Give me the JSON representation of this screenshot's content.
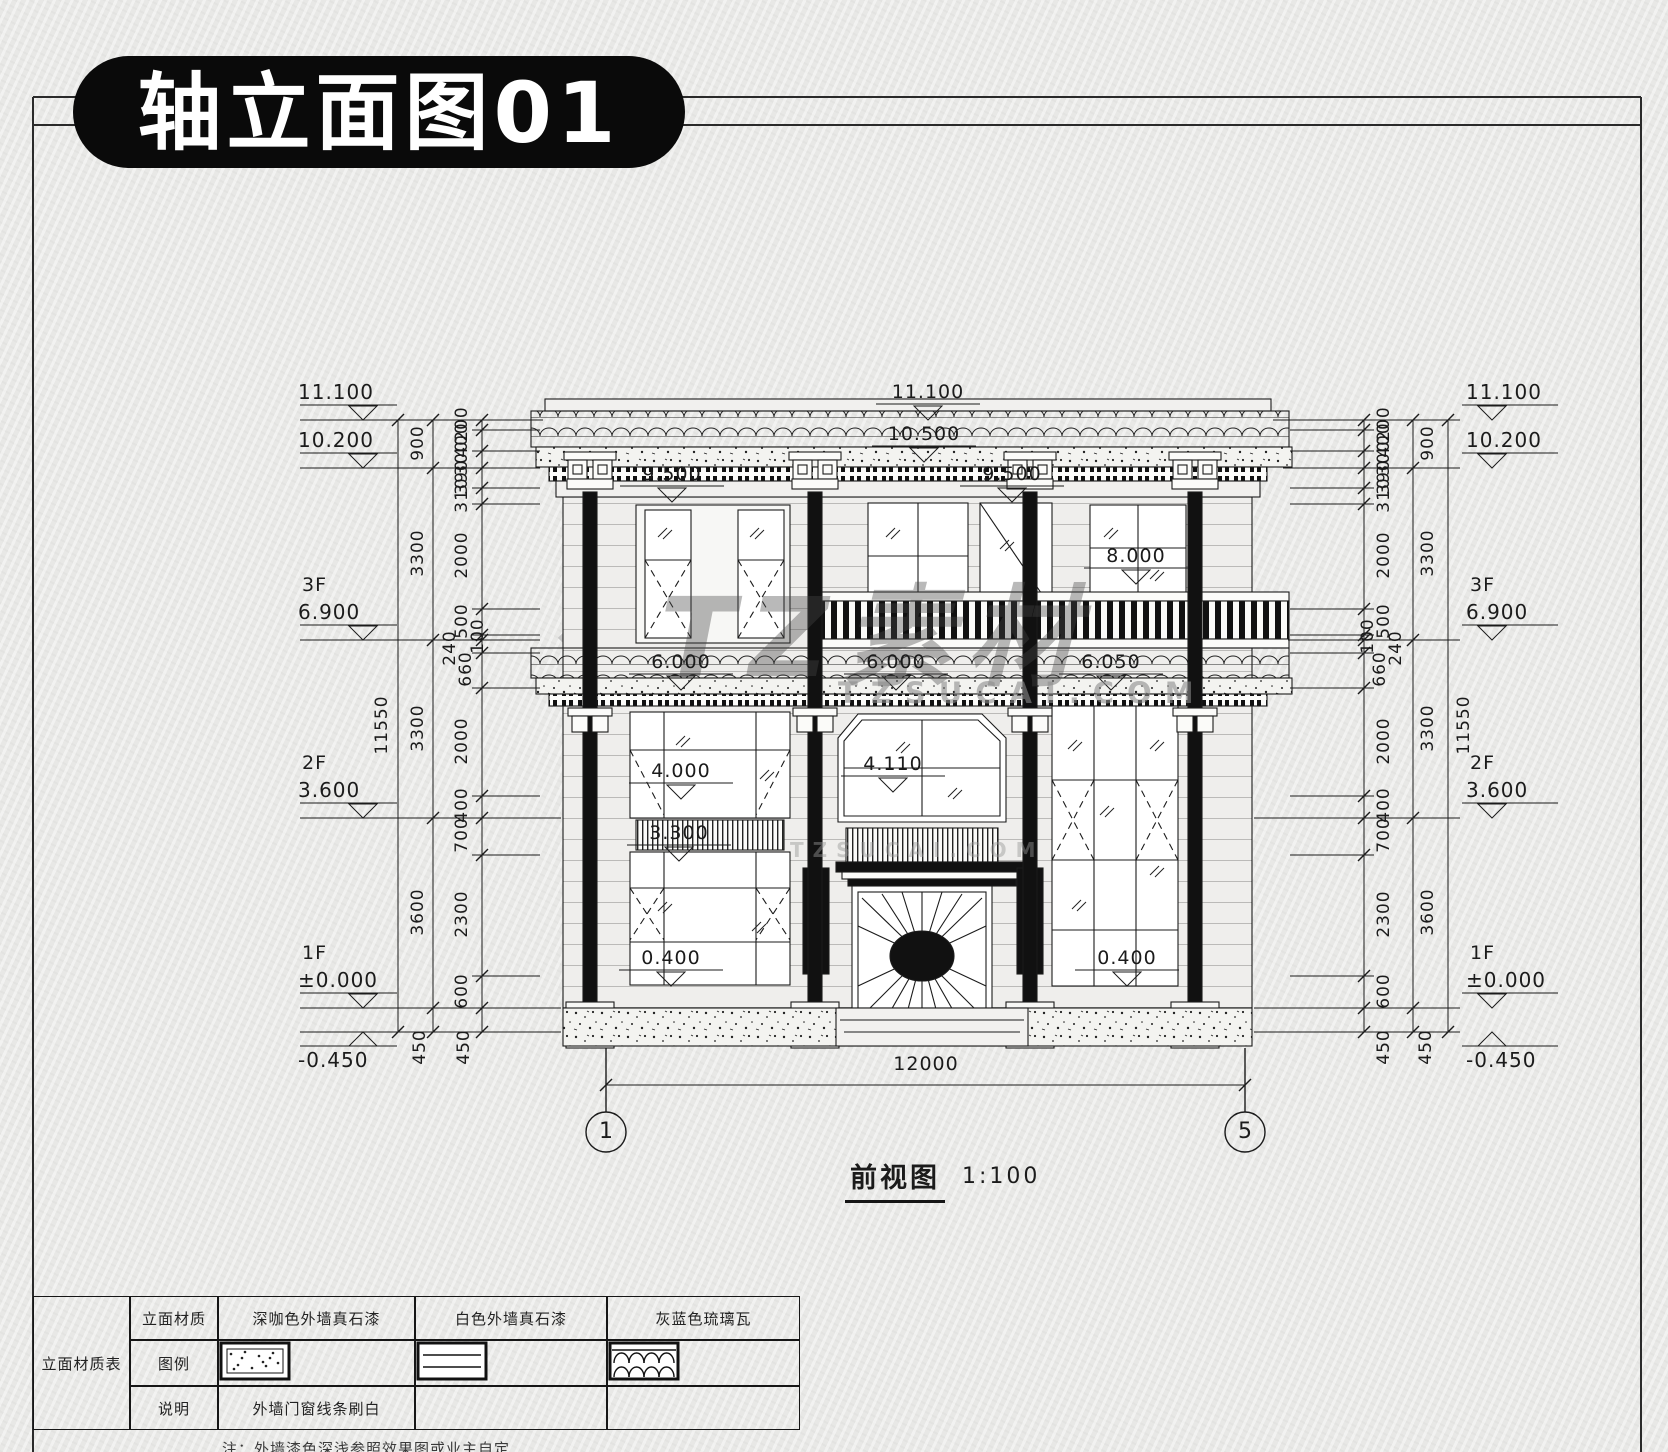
{
  "title": "轴立面图01",
  "caption": {
    "name": "前视图",
    "scale": "1:100"
  },
  "axis": {
    "left": "1",
    "right": "5"
  },
  "watermarks": {
    "big": "TZ素材",
    "site": "TZSUCAI.COM",
    "site_small": "TZSUCAI.COM"
  },
  "note": "注：外墙漆色深浅参照效果图或业主自定",
  "levels_left": [
    {
      "floor": "",
      "value": "11.100"
    },
    {
      "floor": "",
      "value": "10.200"
    },
    {
      "floor": "3F",
      "value": "6.900"
    },
    {
      "floor": "2F",
      "value": "3.600"
    },
    {
      "floor": "1F",
      "value": "±0.000"
    },
    {
      "floor": "",
      "value": "-0.450"
    }
  ],
  "levels_right": [
    {
      "floor": "",
      "value": "11.100"
    },
    {
      "floor": "",
      "value": "10.200"
    },
    {
      "floor": "3F",
      "value": "6.900"
    },
    {
      "floor": "2F",
      "value": "3.600"
    },
    {
      "floor": "1F",
      "value": "±0.000"
    },
    {
      "floor": "",
      "value": "-0.450"
    }
  ],
  "vdims_left": [
    {
      "t": "11550",
      "x": 382,
      "y": 726
    },
    {
      "t": "900",
      "x": 418,
      "y": 444
    },
    {
      "t": "3300",
      "x": 418,
      "y": 554
    },
    {
      "t": "3300",
      "x": 418,
      "y": 729
    },
    {
      "t": "3600",
      "x": 418,
      "y": 913
    },
    {
      "t": "450",
      "x": 420,
      "y": 1048
    },
    {
      "t": "200",
      "x": 462,
      "y": 425
    },
    {
      "t": "400",
      "x": 462,
      "y": 441
    },
    {
      "t": "300",
      "x": 462,
      "y": 459
    },
    {
      "t": "390",
      "x": 462,
      "y": 478
    },
    {
      "t": "310",
      "x": 462,
      "y": 496
    },
    {
      "t": "2000",
      "x": 462,
      "y": 556
    },
    {
      "t": "500",
      "x": 462,
      "y": 622
    },
    {
      "t": "100",
      "x": 478,
      "y": 637
    },
    {
      "t": "240",
      "x": 450,
      "y": 649
    },
    {
      "t": "660",
      "x": 466,
      "y": 670
    },
    {
      "t": "2000",
      "x": 462,
      "y": 742
    },
    {
      "t": "400",
      "x": 462,
      "y": 806
    },
    {
      "t": "700",
      "x": 462,
      "y": 836
    },
    {
      "t": "2300",
      "x": 462,
      "y": 915
    },
    {
      "t": "600",
      "x": 462,
      "y": 992
    },
    {
      "t": "450",
      "x": 464,
      "y": 1048
    }
  ],
  "vdims_right": [
    {
      "t": "11550",
      "x": 1464,
      "y": 726
    },
    {
      "t": "900",
      "x": 1428,
      "y": 444
    },
    {
      "t": "3300",
      "x": 1428,
      "y": 554
    },
    {
      "t": "3300",
      "x": 1428,
      "y": 729
    },
    {
      "t": "3600",
      "x": 1428,
      "y": 913
    },
    {
      "t": "450",
      "x": 1426,
      "y": 1048
    },
    {
      "t": "200",
      "x": 1384,
      "y": 425
    },
    {
      "t": "400",
      "x": 1384,
      "y": 441
    },
    {
      "t": "300",
      "x": 1384,
      "y": 459
    },
    {
      "t": "390",
      "x": 1384,
      "y": 478
    },
    {
      "t": "310",
      "x": 1384,
      "y": 496
    },
    {
      "t": "2000",
      "x": 1384,
      "y": 556
    },
    {
      "t": "500",
      "x": 1384,
      "y": 622
    },
    {
      "t": "100",
      "x": 1368,
      "y": 637
    },
    {
      "t": "240",
      "x": 1396,
      "y": 649
    },
    {
      "t": "660",
      "x": 1380,
      "y": 670
    },
    {
      "t": "2000",
      "x": 1384,
      "y": 742
    },
    {
      "t": "400",
      "x": 1384,
      "y": 806
    },
    {
      "t": "700",
      "x": 1384,
      "y": 836
    },
    {
      "t": "2300",
      "x": 1384,
      "y": 915
    },
    {
      "t": "600",
      "x": 1384,
      "y": 992
    },
    {
      "t": "450",
      "x": 1384,
      "y": 1048
    }
  ],
  "labels": [
    {
      "t": "11.100",
      "x": 928,
      "y": 392,
      "m": 1
    },
    {
      "t": "10.500",
      "x": 924,
      "y": 434,
      "m": 1
    },
    {
      "t": "9.500",
      "x": 672,
      "y": 474,
      "m": 1
    },
    {
      "t": "9.500",
      "x": 1012,
      "y": 474,
      "m": 1
    },
    {
      "t": "8.000",
      "x": 1136,
      "y": 556,
      "m": 1
    },
    {
      "t": "6.000",
      "x": 681,
      "y": 662,
      "m": 1
    },
    {
      "t": "6.000",
      "x": 896,
      "y": 662,
      "m": 1
    },
    {
      "t": "6.050",
      "x": 1111,
      "y": 662,
      "m": 1
    },
    {
      "t": "4.000",
      "x": 681,
      "y": 771,
      "m": 1
    },
    {
      "t": "4.110",
      "x": 893,
      "y": 764,
      "m": 1
    },
    {
      "t": "3.300",
      "x": 679,
      "y": 833,
      "m": 1
    },
    {
      "t": "0.400",
      "x": 671,
      "y": 958,
      "m": 1
    },
    {
      "t": "0.400",
      "x": 1127,
      "y": 958,
      "m": 1
    },
    {
      "t": "12000",
      "x": 926,
      "y": 1064,
      "m": 0
    }
  ],
  "table": {
    "title": "立面材质表",
    "row_labels": [
      "立面材质",
      "图例",
      "说明"
    ],
    "materials": [
      "深咖色外墙真石漆",
      "白色外墙真石漆",
      "灰蓝色琉璃瓦"
    ],
    "swatches": [
      "speckle",
      "lines",
      "tiles"
    ],
    "notes": [
      "外墙门窗线条刷白",
      "",
      ""
    ]
  }
}
